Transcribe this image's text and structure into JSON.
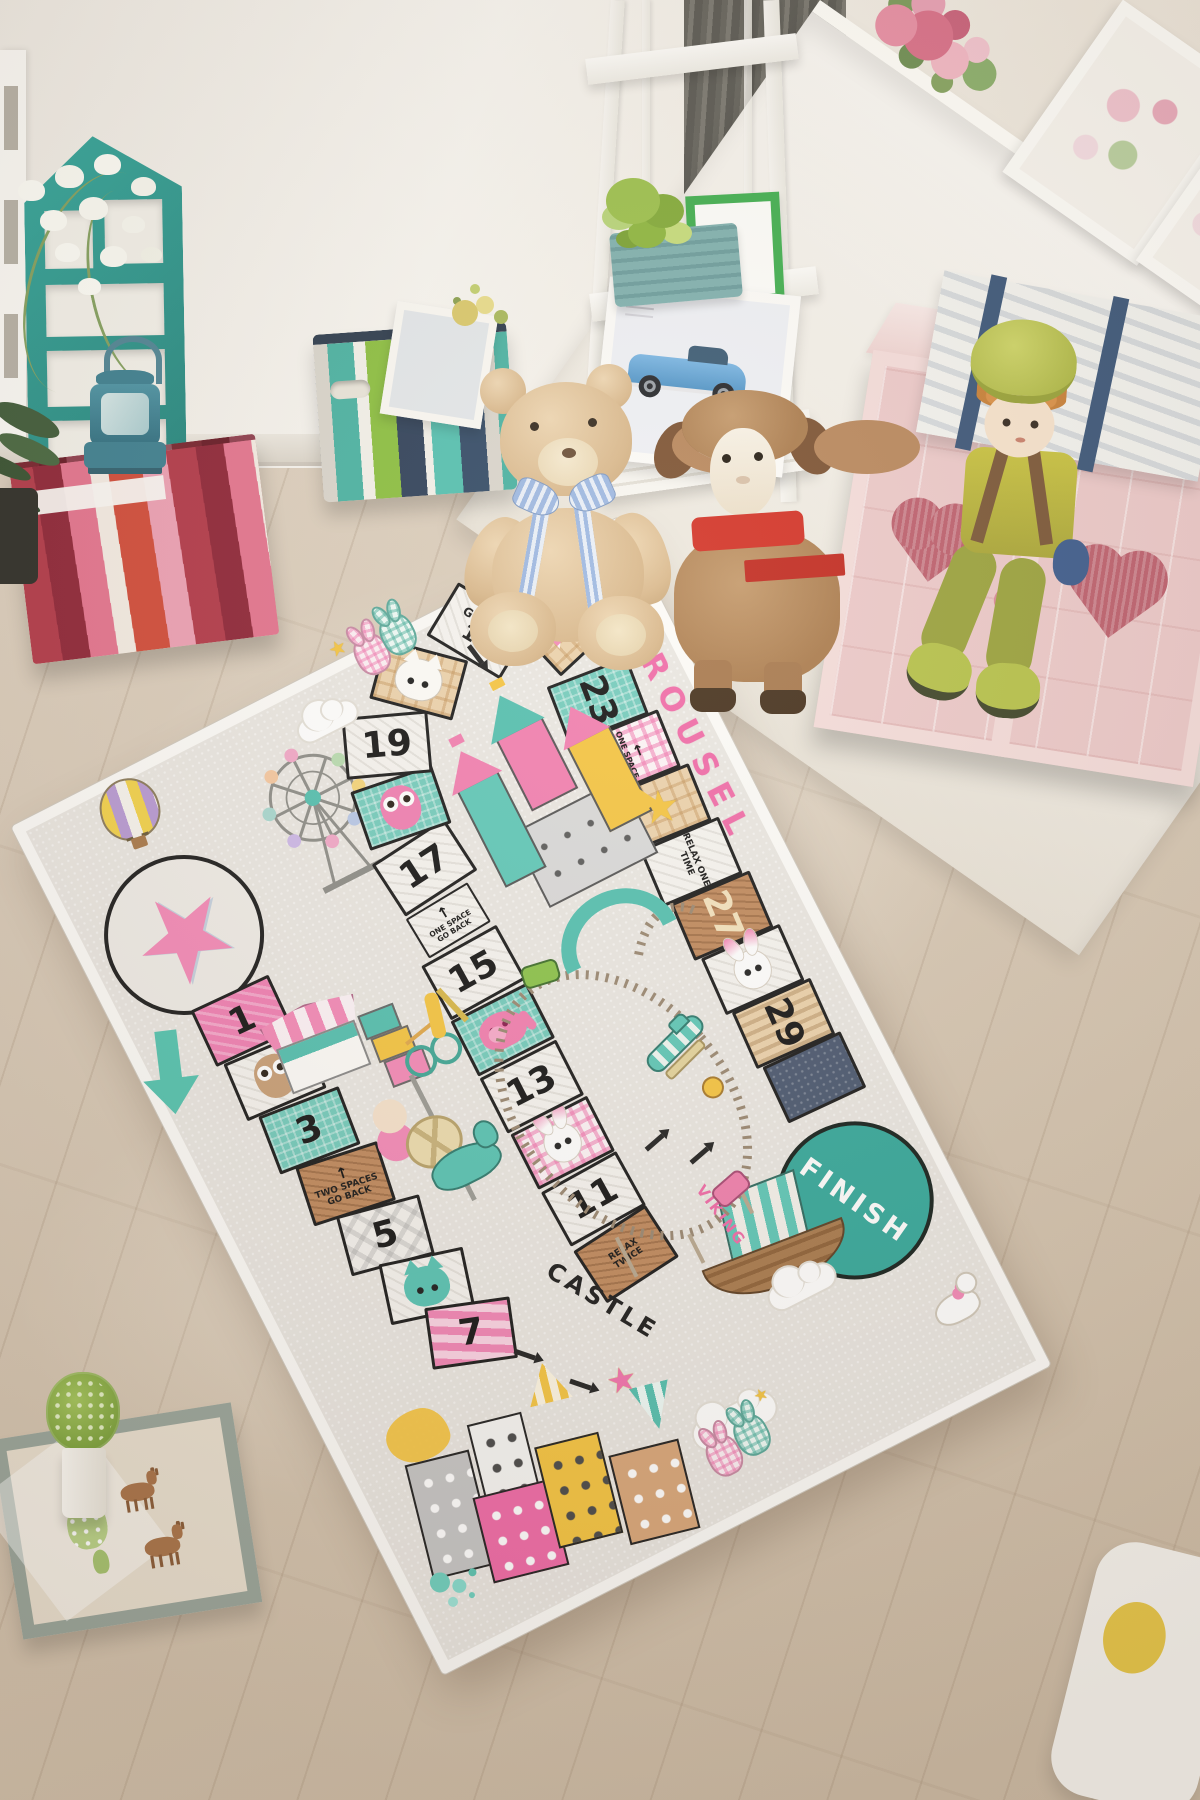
{
  "rug": {
    "title": "CAROUSEL",
    "castle_label": "CASTLE",
    "viking_label": "VIKING",
    "finish_label": "FINISH",
    "goto": {
      "line1": "GO TO",
      "line2": "13"
    },
    "numbers": {
      "n1": "1",
      "n3": "3",
      "n5": "5",
      "n7": "7",
      "n11": "11",
      "n13": "13",
      "n15": "15",
      "n17": "17",
      "n19": "19",
      "n23": "23",
      "n27": "27",
      "n29": "29"
    },
    "instructions": {
      "two_back": "TWO SPACES GO BACK",
      "one_back": "ONE SPACE GO BACK",
      "relax_twice": "RELAX TWICE",
      "relax_one": "RELAX ONE TIME"
    },
    "icons": {
      "star": "★",
      "arrow_up": "↑",
      "arrow_left": "←"
    },
    "colors": {
      "pink": "#f06ba8",
      "teal": "#5fc8b8",
      "tan": "#cfa06e",
      "navy": "#4a5870",
      "yellow": "#f5c542",
      "finish_teal": "#35a99c"
    }
  }
}
